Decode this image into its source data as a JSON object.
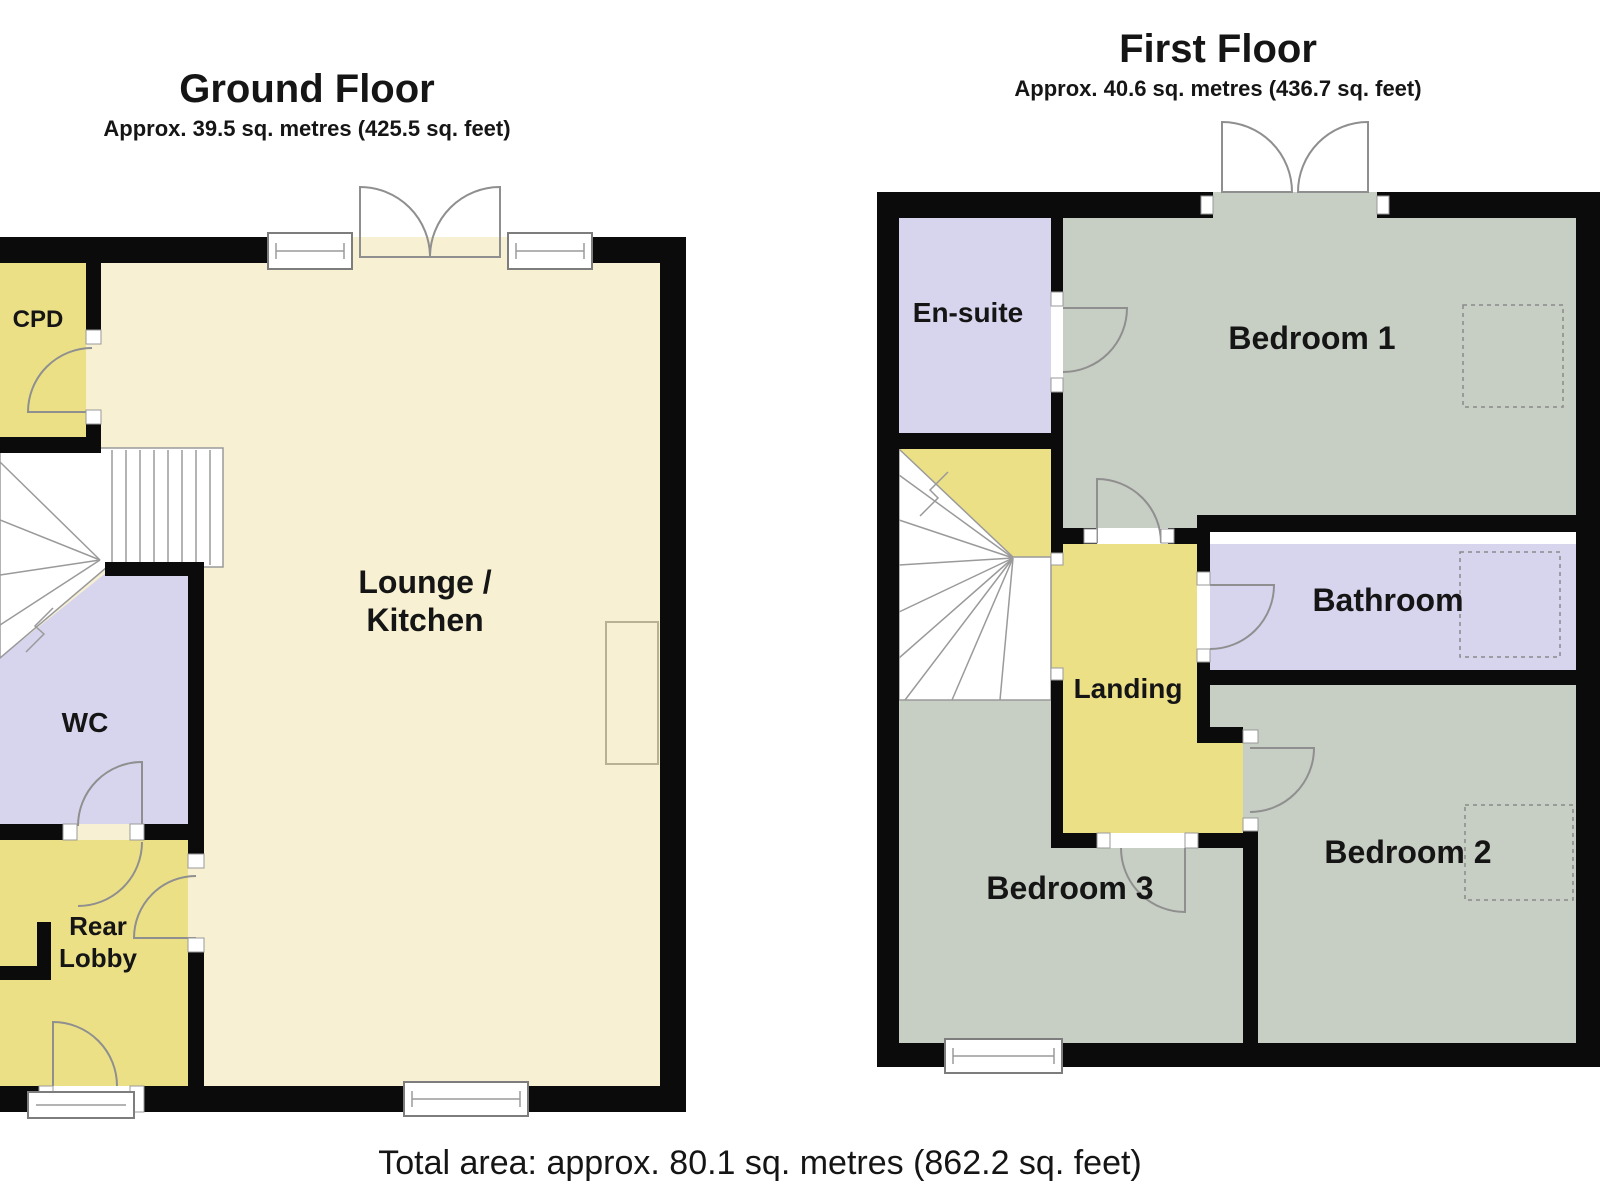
{
  "ground_floor": {
    "title": "Ground Floor",
    "subtitle": "Approx. 39.5 sq. metres (425.5 sq. feet)",
    "rooms": {
      "cpd": "CPD",
      "lounge_line1": "Lounge /",
      "lounge_line2": "Kitchen",
      "wc": "WC",
      "rear_lobby_line1": "Rear",
      "rear_lobby_line2": "Lobby"
    }
  },
  "first_floor": {
    "title": "First Floor",
    "subtitle": "Approx. 40.6 sq. metres (436.7 sq. feet)",
    "rooms": {
      "en_suite": "En-suite",
      "bedroom1": "Bedroom 1",
      "bathroom": "Bathroom",
      "landing": "Landing",
      "bedroom2": "Bedroom 2",
      "bedroom3": "Bedroom 3"
    }
  },
  "footer": {
    "total_area": "Total area: approx. 80.1 sq. metres (862.2 sq. feet)"
  },
  "colors": {
    "floor_cream": "#f7f0d2",
    "floor_yellow": "#ece087",
    "floor_lavender": "#d7d5ee",
    "floor_grey": "#c7cec3",
    "wall": "#0b0b0b",
    "detail_line": "#8f8f8f",
    "background": "#ffffff"
  }
}
